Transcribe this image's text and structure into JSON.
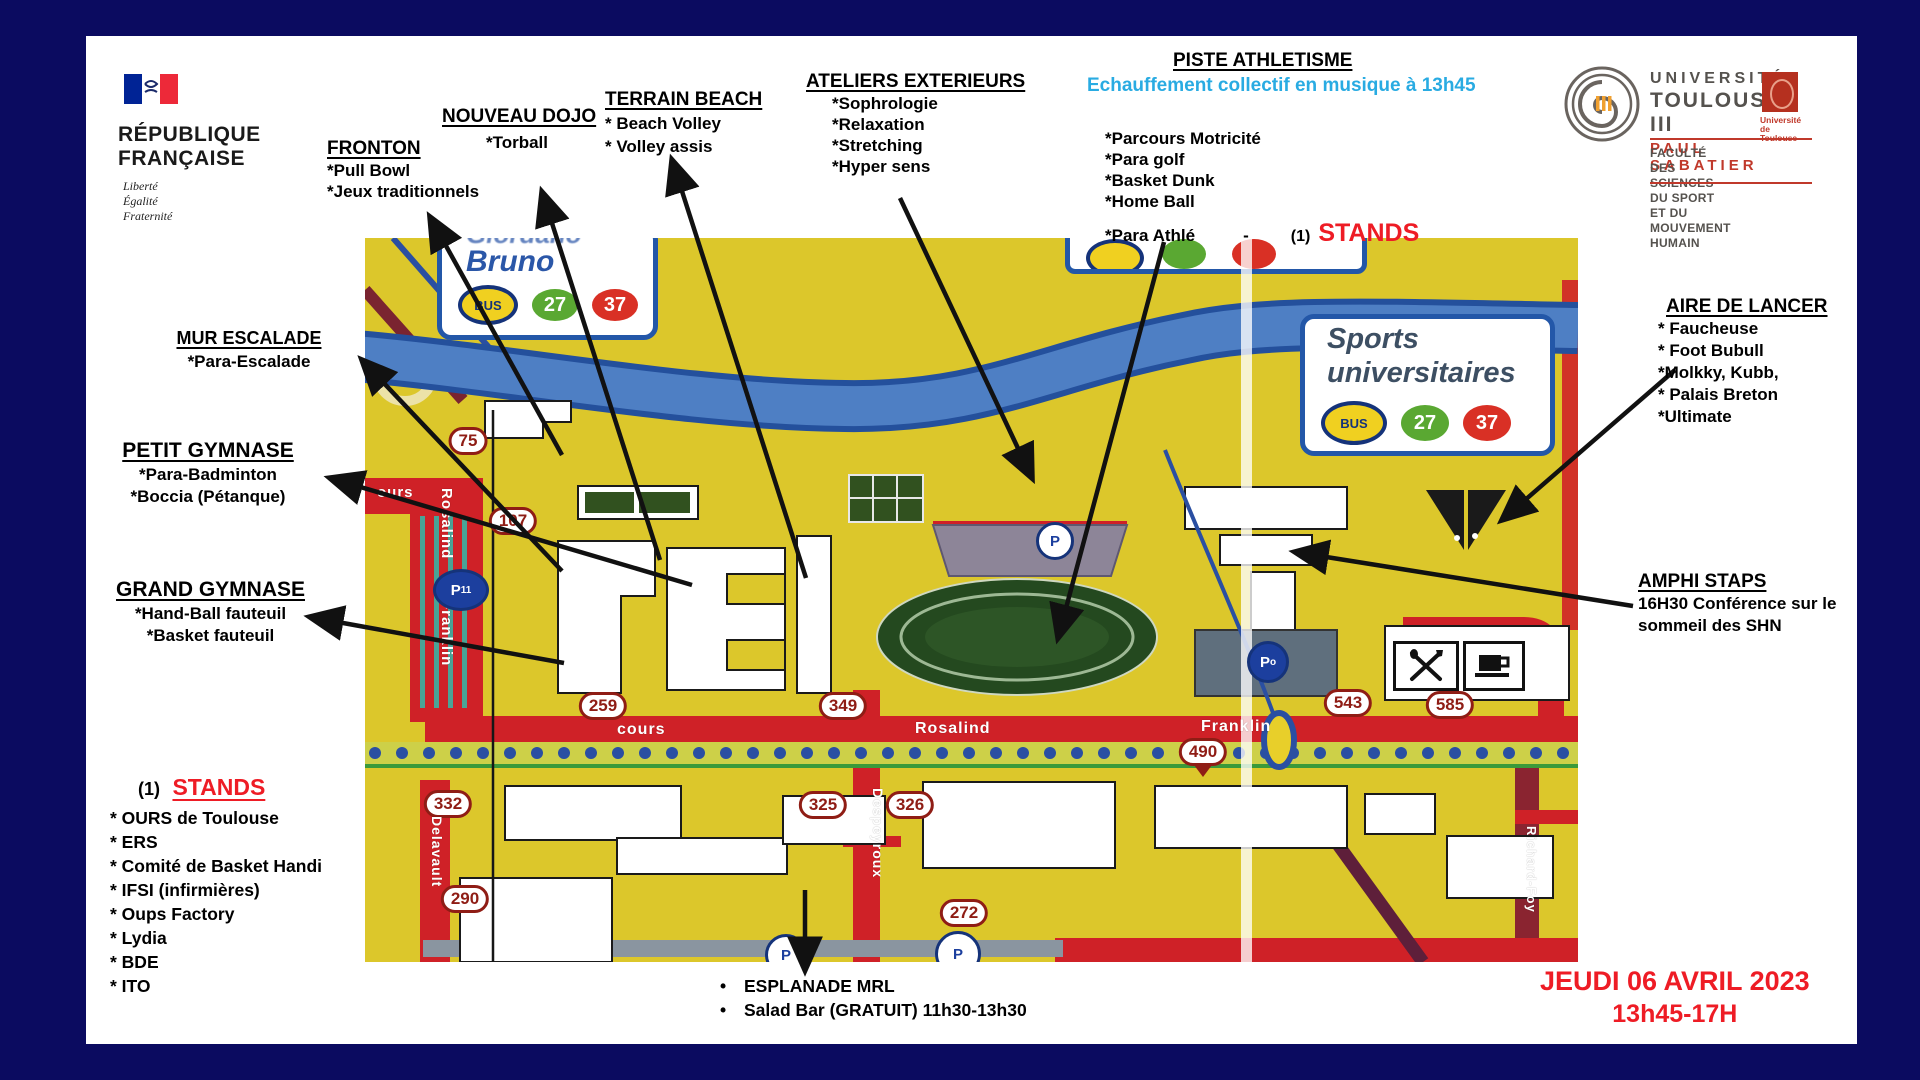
{
  "header": {
    "republique": {
      "line1": "RÉPUBLIQUE",
      "line2": "FRANÇAISE",
      "motto": [
        "Liberté",
        "Égalité",
        "Fraternité"
      ]
    },
    "universite": {
      "line1": "UNIVERSITÉ",
      "line2": "TOULOUSE III",
      "line3": "PAUL SABATIER",
      "badge_line1": "Université",
      "badge_line2": "de Toulouse",
      "faculty_line1": "FACULTÉ DES SCIENCES DU SPORT",
      "faculty_line2": "ET DU MOUVEMENT HUMAIN"
    }
  },
  "labels": {
    "fronton": {
      "title": "FRONTON",
      "items": [
        "*Pull Bowl",
        "*Jeux traditionnels"
      ]
    },
    "nouveau_dojo": {
      "title": "NOUVEAU DOJO",
      "items": [
        "*Torball"
      ]
    },
    "terrain_beach": {
      "title": "TERRAIN BEACH",
      "items": [
        "* Beach Volley",
        "* Volley assis"
      ]
    },
    "ateliers": {
      "title": "ATELIERS EXTERIEURS",
      "items": [
        "*Sophrologie",
        "*Relaxation",
        "*Stretching",
        "*Hyper sens"
      ]
    },
    "piste": {
      "title": "PISTE ATHLETISME",
      "subtitle": "Echauffement collectif en musique à 13h45",
      "items": [
        "*Parcours Motricité",
        "*Para golf",
        "*Basket Dunk",
        "*Home Ball"
      ],
      "last_item": "*Para Athlé",
      "dash": "-",
      "stands_ref": "(1)",
      "stands_word": "STANDS"
    },
    "mur_escalade": {
      "title": "MUR  ESCALADE",
      "items": [
        "*Para-Escalade"
      ]
    },
    "petit_gymnase": {
      "title": "PETIT GYMNASE",
      "items": [
        "*Para-Badminton",
        "*Boccia (Pétanque)"
      ]
    },
    "grand_gymnase": {
      "title": "GRAND GYMNASE",
      "items": [
        "*Hand-Ball fauteuil",
        "*Basket fauteuil"
      ]
    },
    "aire_de_lancer": {
      "title": "AIRE DE LANCER",
      "items": [
        "* Faucheuse",
        "* Foot Bubull",
        "*Molkky, Kubb,",
        "* Palais Breton",
        "*Ultimate"
      ]
    },
    "amphi": {
      "title": "AMPHI STAPS",
      "items": [
        "16H30 Conférence sur le",
        "sommeil des SHN"
      ]
    },
    "stands": {
      "ref": "(1)",
      "title": "STANDS",
      "items": [
        "* OURS de Toulouse",
        "* ERS",
        "* Comité de Basket Handi",
        "* IFSI (infirmières)",
        "* Oups Factory",
        "* Lydia",
        "* BDE",
        "* ITO"
      ]
    },
    "esplanade": {
      "items": [
        "ESPLANADE MRL",
        "Salad Bar  (GRATUIT)   11h30-13h30"
      ]
    },
    "date": {
      "line1": "JEUDI 06 AVRIL 2023",
      "line2": "13h45-17H"
    }
  },
  "map": {
    "signs": {
      "bruno": {
        "top_partial": "Giordano",
        "name": "Bruno",
        "bus": "BUS",
        "line_green": "27",
        "line_red": "37"
      },
      "sports": {
        "line1": "Sports",
        "line2": "universitaires",
        "bus": "BUS",
        "line_green": "27",
        "line_red": "37"
      }
    },
    "street_numbers": [
      {
        "label": "75",
        "x": 103,
        "y": 203
      },
      {
        "label": "107",
        "x": 148,
        "y": 283
      },
      {
        "label": "259",
        "x": 238,
        "y": 468
      },
      {
        "label": "349",
        "x": 478,
        "y": 468
      },
      {
        "label": "543",
        "x": 983,
        "y": 465
      },
      {
        "label": "585",
        "x": 1085,
        "y": 467
      },
      {
        "label": "490",
        "x": 838,
        "y": 514,
        "pointer": true
      },
      {
        "label": "332",
        "x": 83,
        "y": 566
      },
      {
        "label": "290",
        "x": 100,
        "y": 661
      },
      {
        "label": "325",
        "x": 458,
        "y": 567
      },
      {
        "label": "326",
        "x": 545,
        "y": 567
      },
      {
        "label": "272",
        "x": 599,
        "y": 675
      }
    ],
    "streets": [
      {
        "label": "ours",
        "x": 12,
        "y": 246,
        "size": 15
      },
      {
        "label": "Rosalind",
        "x": 90,
        "y": 250,
        "size": 15,
        "vertical": true
      },
      {
        "label": "Franklin",
        "x": 90,
        "y": 362,
        "size": 15,
        "vertical": true
      },
      {
        "label": "cours",
        "x": 252,
        "y": 483,
        "size": 16
      },
      {
        "label": "Rosalind",
        "x": 550,
        "y": 482,
        "size": 16
      },
      {
        "label": "Franklin",
        "x": 836,
        "y": 480,
        "size": 16
      },
      {
        "label": "Delavault",
        "x": 80,
        "y": 578,
        "size": 14,
        "vertical": true
      },
      {
        "label": "Despeyroux",
        "x": 521,
        "y": 550,
        "size": 14,
        "vertical": true
      },
      {
        "label": "Richard-Foy",
        "x": 1174,
        "y": 588,
        "size": 13,
        "vertical": true
      }
    ],
    "parkings": [
      {
        "label": "P",
        "sub": "11",
        "x": 96,
        "y": 352,
        "w": 50,
        "h": 36,
        "bg": "#1c3f9e",
        "fg": "#ffffff"
      },
      {
        "label": "P",
        "sub": "",
        "x": 690,
        "y": 303,
        "w": 32,
        "h": 32,
        "bg": "#ffffff",
        "fg": "#1c3f9e"
      },
      {
        "label": "P",
        "sub": "o",
        "x": 903,
        "y": 424,
        "w": 36,
        "h": 36,
        "bg": "#1c3f9e",
        "fg": "#ffffff"
      },
      {
        "label": "P",
        "sub": "",
        "x": 421,
        "y": 717,
        "w": 36,
        "h": 36,
        "bg": "#ffffff",
        "fg": "#1c3f9e"
      },
      {
        "label": "P",
        "sub": "",
        "x": 593,
        "y": 716,
        "w": 40,
        "h": 40,
        "bg": "#ffffff",
        "fg": "#1c3f9e"
      }
    ],
    "icons": [
      "restaurant-icon",
      "cafe-icon"
    ]
  },
  "colors": {
    "background_navy": "#0b0b60",
    "map_yellow": "#dcc72b",
    "road_red": "#cf2127",
    "badge_dark_red": "#8f1d15",
    "river_blue": "#4e7fc4",
    "sign_border_blue": "#2357a8",
    "stands_red": "#ee1c25",
    "date_red": "#ee1c25",
    "subtitle_cyan": "#29abe2",
    "bus_yellow": "#f0d020",
    "line_27_green": "#5aa832",
    "line_37_red": "#d93025"
  }
}
